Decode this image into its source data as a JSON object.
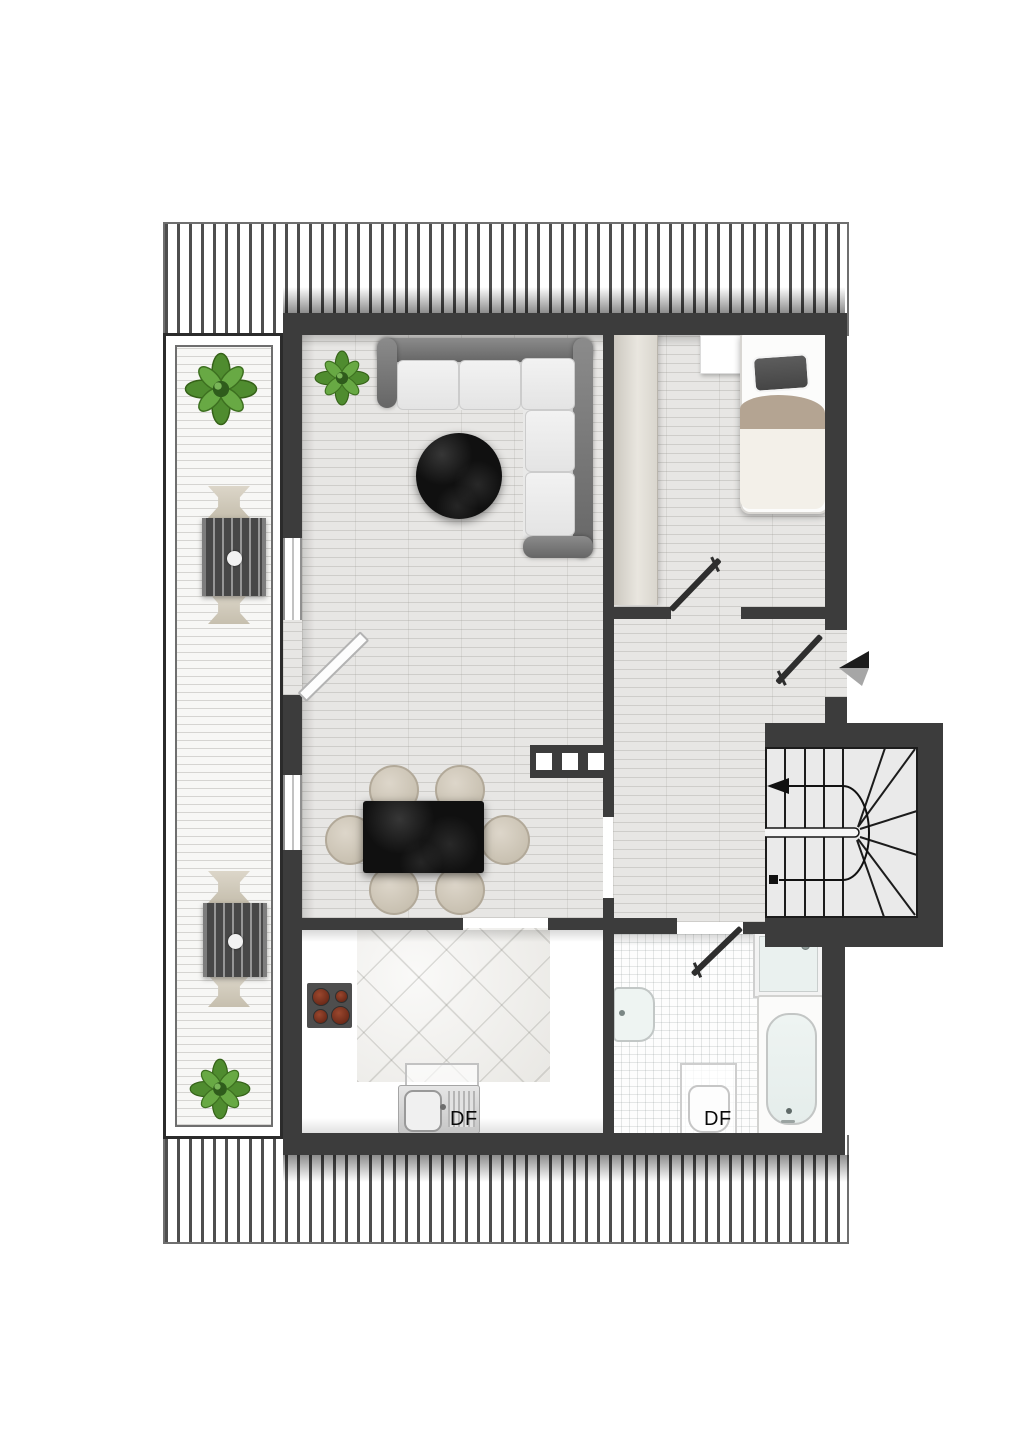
{
  "floor_plan": {
    "type": "apartment-attic-floor-plan",
    "labels": {
      "kitchen_roof_window": "DF",
      "bathroom_roof_window": "DF"
    },
    "colors": {
      "wall": "#3c3c3c",
      "wood_floor": "#e7e6e4",
      "terrace_deck": "#f7f7f5",
      "sofa_back": "#7a7a7a",
      "sofa_cushion": "#ededed",
      "marble_black": "#101010",
      "chair_beige": "#cec6b7",
      "bed_blanket": "#b4a492",
      "plant_green": "#569334",
      "stair_floor": "#eaeaea",
      "burner_red": "#7c3320",
      "arrow_black": "#1c1c1c",
      "arrow_gray": "#a6a6a6"
    },
    "rooms": [
      "terrace",
      "living-dining-room",
      "bedroom",
      "hallway",
      "kitchen",
      "bathroom",
      "staircase"
    ],
    "furniture": [
      "corner-sofa",
      "round-coffee-table",
      "dining-table-with-6-chairs",
      "single-bed",
      "nightstand",
      "wardrobe",
      "two-terrace-dining-sets",
      "four-potted-plants",
      "cooktop",
      "kitchen-sink",
      "bathroom-sink",
      "toilet",
      "shower",
      "bathtub"
    ],
    "entrance": {
      "arrow_direction": "left"
    },
    "stairs": {
      "shape": "u-turn-winder",
      "direction_arrow": "left"
    }
  }
}
